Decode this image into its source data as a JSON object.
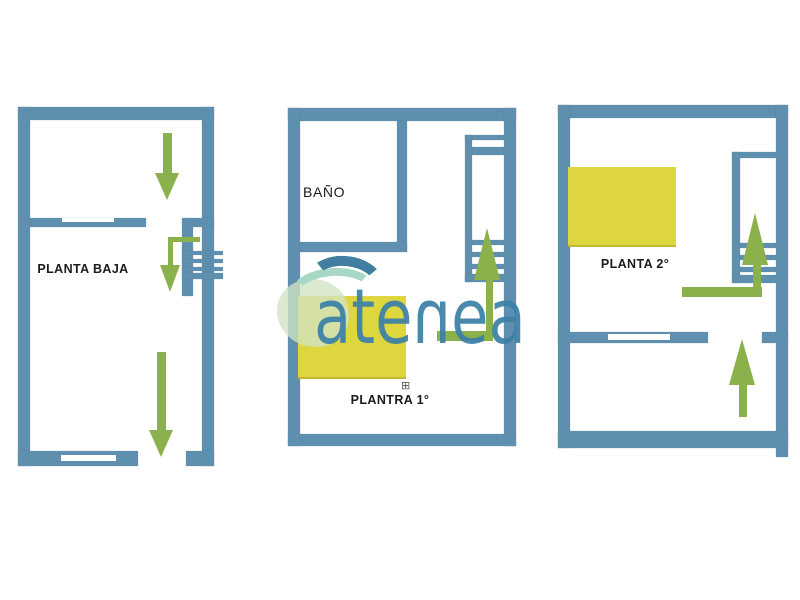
{
  "plans": {
    "planta_baja": {
      "label": "PLANTA BAJA"
    },
    "planta_primera": {
      "label": "PLANTRA 1°",
      "bath_label": "BAÑO",
      "window_marker": "⊞"
    },
    "planta_segunda": {
      "label": "PLANTA 2°"
    }
  },
  "logo": {
    "text": "atenea",
    "letters": [
      "a",
      "t",
      "e",
      "n",
      "e",
      "a"
    ]
  },
  "colors": {
    "wall_blue": "#5f8fae",
    "arrow_green": "#8ab14c",
    "furniture_yellow": "#ddd63f",
    "logo_blue": "#3b80a8",
    "logo_wave_dark": "#417ea2",
    "logo_wave_light": "#a7d8c6",
    "logo_cloud": "#d1e3c3",
    "label_black": "#1b1b1b"
  }
}
